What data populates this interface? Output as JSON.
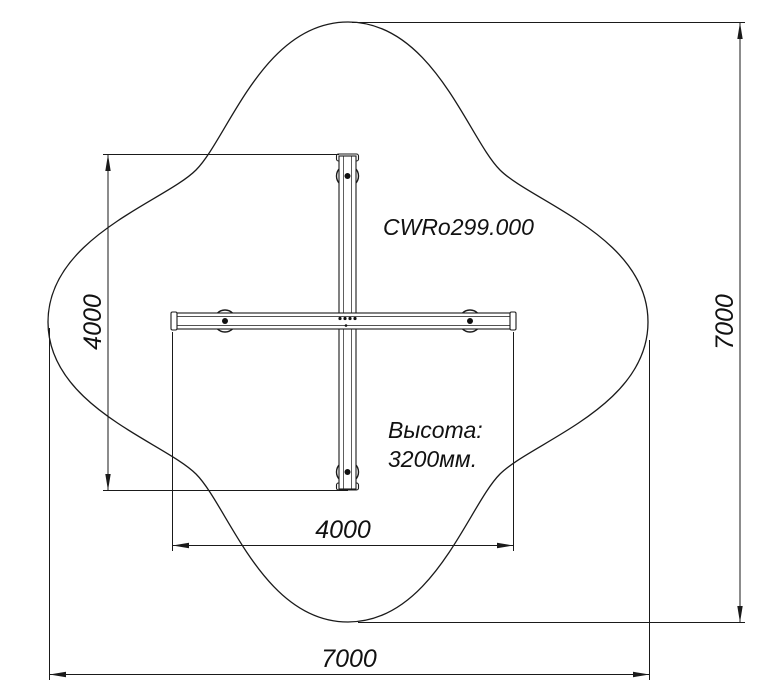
{
  "page": {
    "background_color": "#ffffff",
    "line_color": "#1a1a1a"
  },
  "drawing": {
    "model_label": "CWRo299.000",
    "height_note": {
      "line1": "Высота:",
      "line2": "3200мм."
    },
    "dimensions": {
      "structure_height": "4000",
      "structure_width": "4000",
      "zone_height": "7000",
      "zone_width": "7000"
    }
  }
}
